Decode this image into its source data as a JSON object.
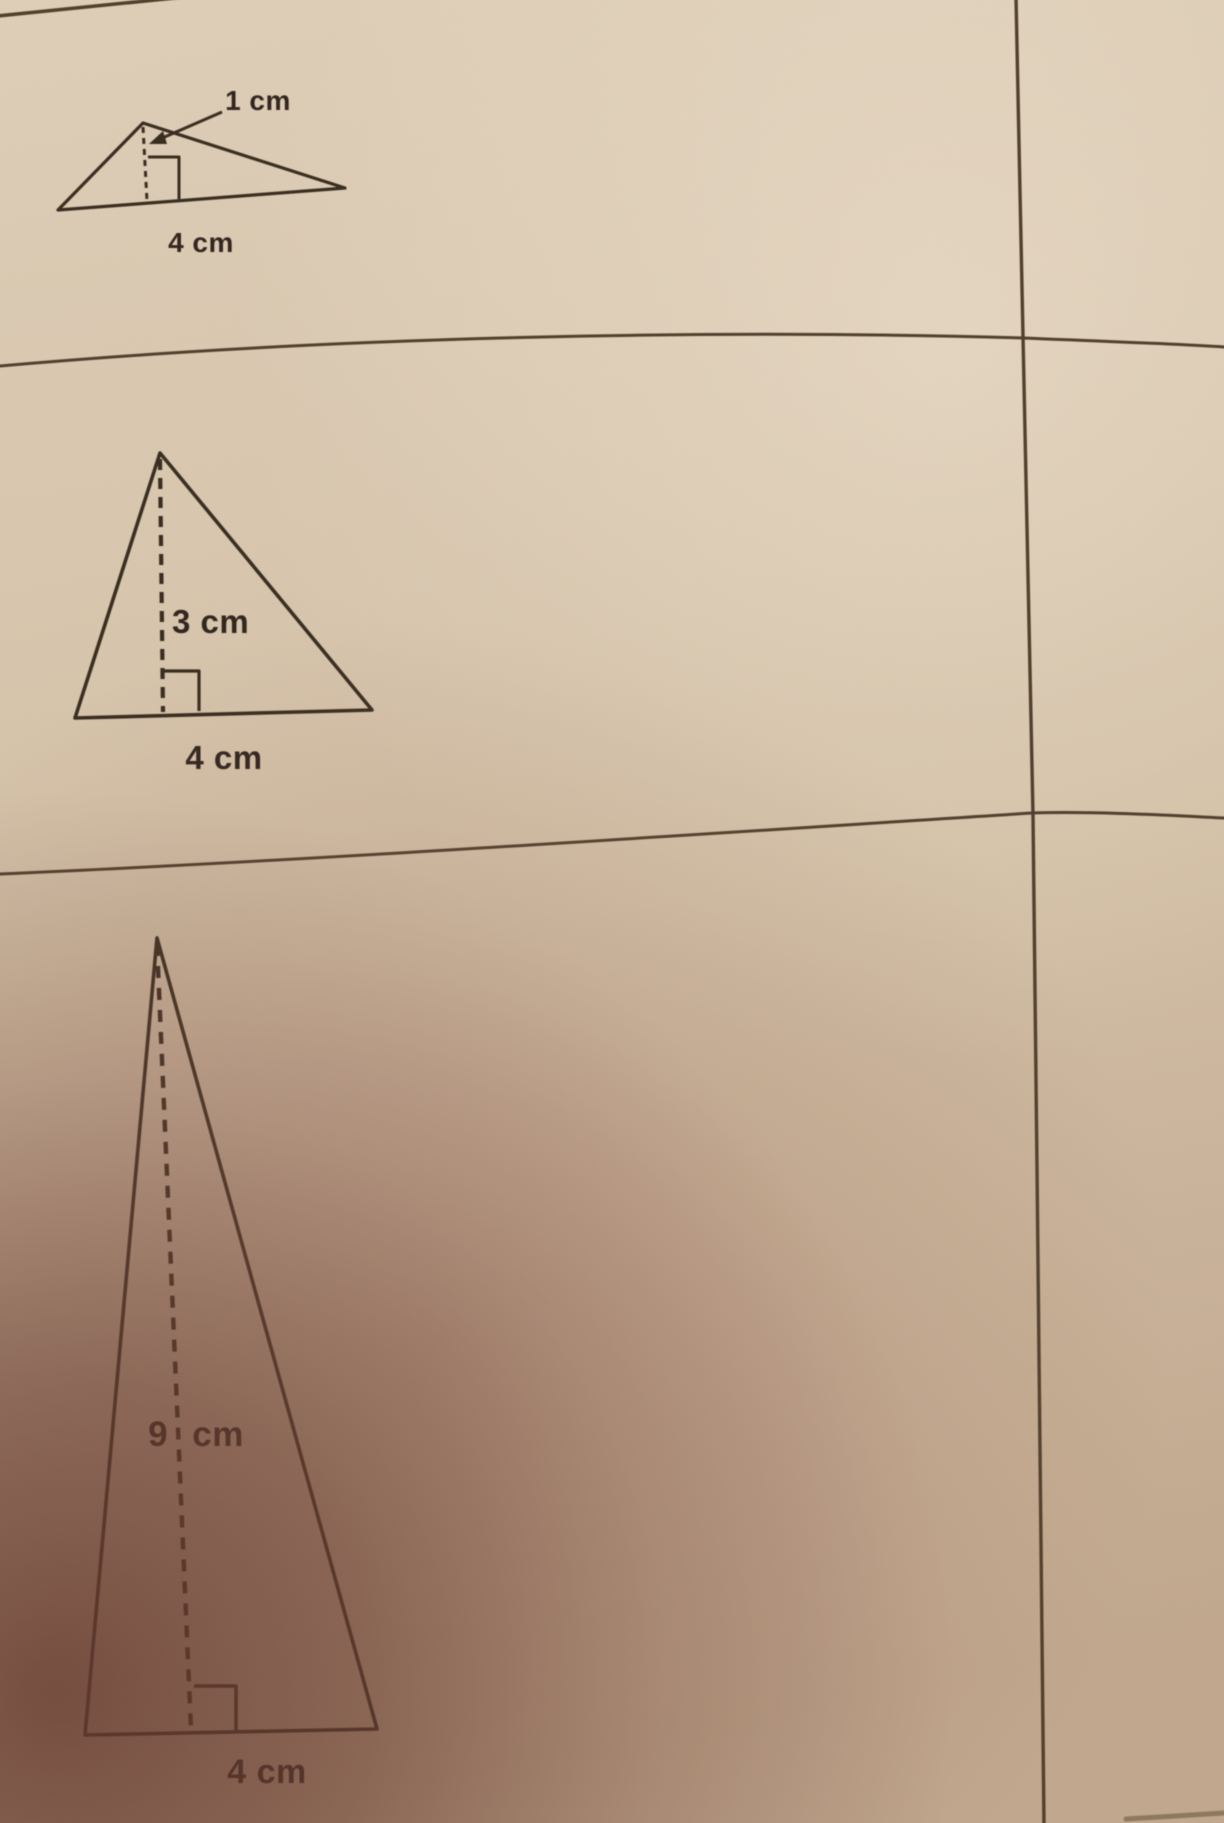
{
  "rows": [
    {
      "height_label": "1 cm",
      "base_label": "4 cm"
    },
    {
      "height_label": "3 cm",
      "base_label": "4 cm"
    },
    {
      "height_label": "9 cm",
      "base_label": "4 cm"
    }
  ],
  "colors": {
    "paper_top": "#dfcfb8",
    "paper_mid": "#d3c0a6",
    "paper_bottom": "#c0a78d",
    "corner_shadow": "#61352a",
    "ink": "#342a1f",
    "grid_line": "#4e3c29"
  }
}
